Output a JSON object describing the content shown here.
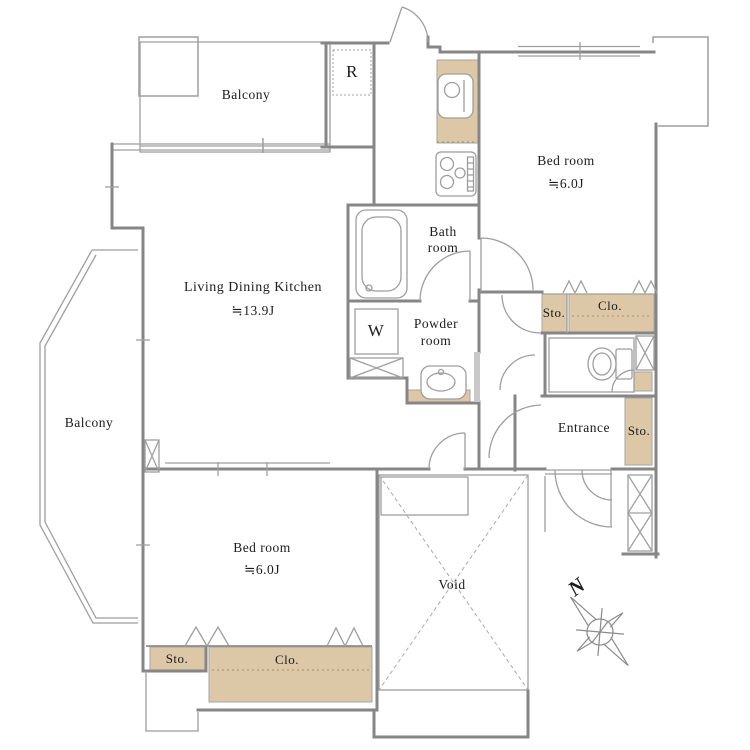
{
  "floorplan": {
    "balconies": {
      "top": "Balcony",
      "left": "Balcony"
    },
    "rooms": {
      "ldk": {
        "name": "Living Dining Kitchen",
        "area": "≒13.9J"
      },
      "bedroom_top": {
        "name": "Bed room",
        "area": "≒6.0J"
      },
      "bedroom_bottom": {
        "name": "Bed room",
        "area": "≒6.0J"
      },
      "bathroom": {
        "line1": "Bath",
        "line2": "room"
      },
      "powder_room": {
        "line1": "Powder",
        "line2": "room"
      },
      "entrance": "Entrance",
      "void": "Void"
    },
    "storage": {
      "bedroom_top_sto": "Sto.",
      "bedroom_top_clo": "Clo.",
      "entrance_sto": "Sto.",
      "bedroom_bottom_sto": "Sto.",
      "bedroom_bottom_clo": "Clo."
    },
    "appliances": {
      "refrigerator": "R",
      "washer": "W"
    },
    "compass": {
      "north": "N"
    },
    "colors": {
      "closet_fill": "#dcc7a6",
      "wall": "#868686",
      "background": "#ffffff",
      "text": "#1c1c1c"
    }
  }
}
